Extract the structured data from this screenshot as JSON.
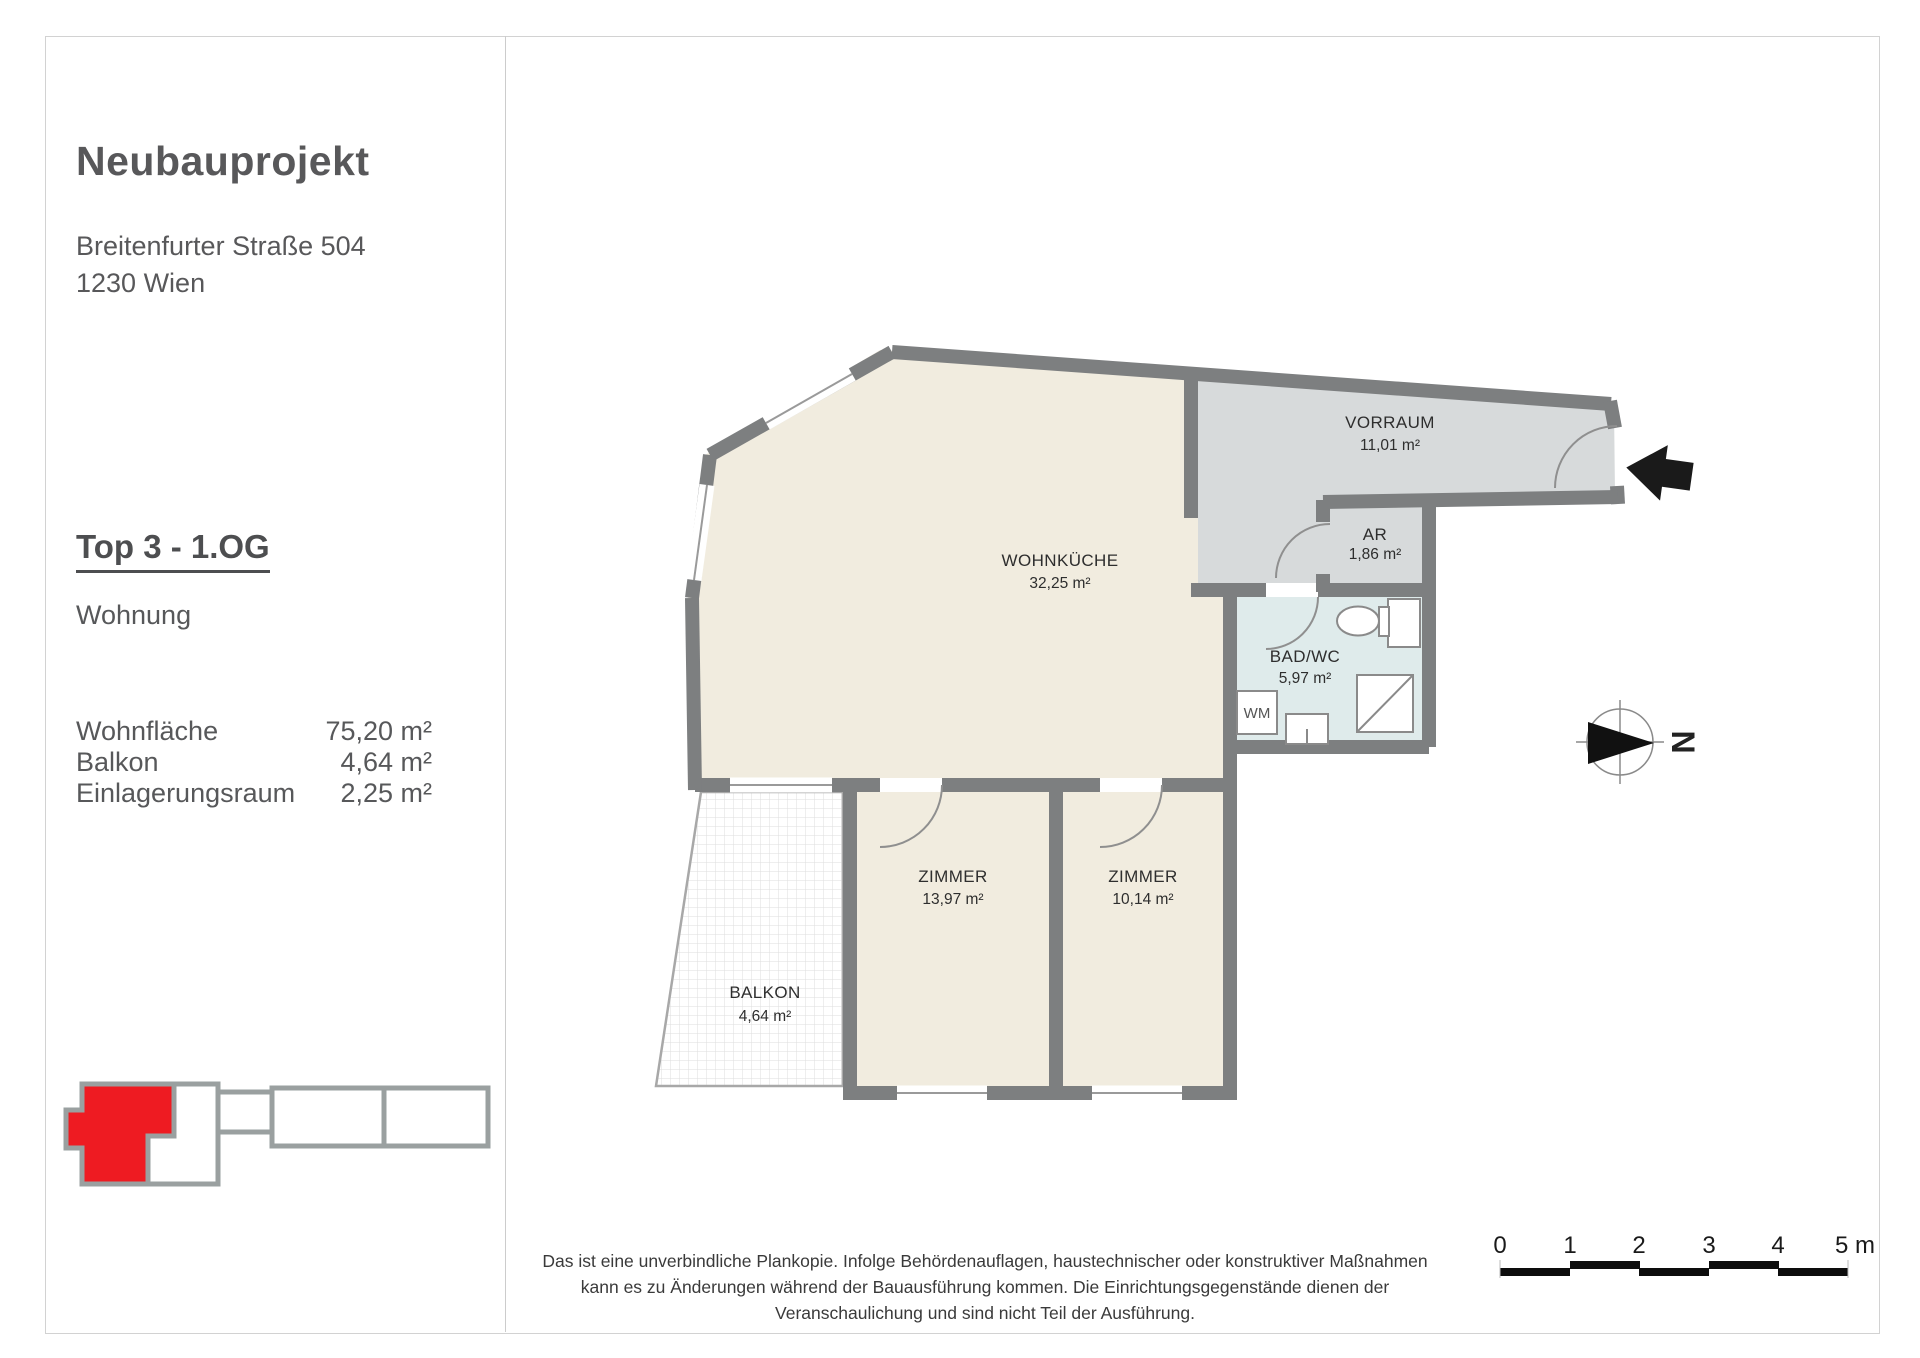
{
  "page": {
    "sidebar": {
      "project_title": "Neubauprojekt",
      "address_line1": "Breitenfurter Straße 504",
      "address_line2": "1230 Wien",
      "unit_title": "Top 3 - 1.OG",
      "unit_type": "Wohnung",
      "areas": [
        {
          "label": "Wohnfläche",
          "value": "75,20 m²"
        },
        {
          "label": "Balkon",
          "value": "4,64 m²"
        },
        {
          "label": "Einlagerungsraum",
          "value": "2,25 m²"
        }
      ]
    },
    "plan": {
      "rooms": [
        {
          "name": "WOHNKÜCHE",
          "area": "32,25 m²"
        },
        {
          "name": "VORRAUM",
          "area": "11,01 m²"
        },
        {
          "name": "AR",
          "area": "1,86 m²"
        },
        {
          "name": "BAD/WC",
          "area": "5,97 m²"
        },
        {
          "name": "ZIMMER",
          "area": "13,97 m²"
        },
        {
          "name": "ZIMMER",
          "area": "10,14 m²"
        },
        {
          "name": "BALKON",
          "area": "4,64 m²"
        }
      ],
      "washing_machine_label": "WM",
      "north_label": "N"
    },
    "scalebar": {
      "ticks": [
        "0",
        "1",
        "2",
        "3",
        "4",
        "5 m"
      ]
    },
    "footer": {
      "line1": "Das ist eine unverbindliche Plankopie. Infolge Behördenauflagen, haustechnischer oder konstruktiver Maßnahmen",
      "line2": "kann es zu Änderungen während der Bauausführung kommen. Die Einrichtungsgegenstände dienen der",
      "line3": "Veranschaulichung und sind nicht Teil der Ausführung."
    },
    "colors": {
      "wall": "#7d7f80",
      "room_cream": "#f1ecdf",
      "room_gray": "#d7dadb",
      "room_bath": "#dfebeb",
      "highlight_red": "#ee1b22"
    }
  }
}
